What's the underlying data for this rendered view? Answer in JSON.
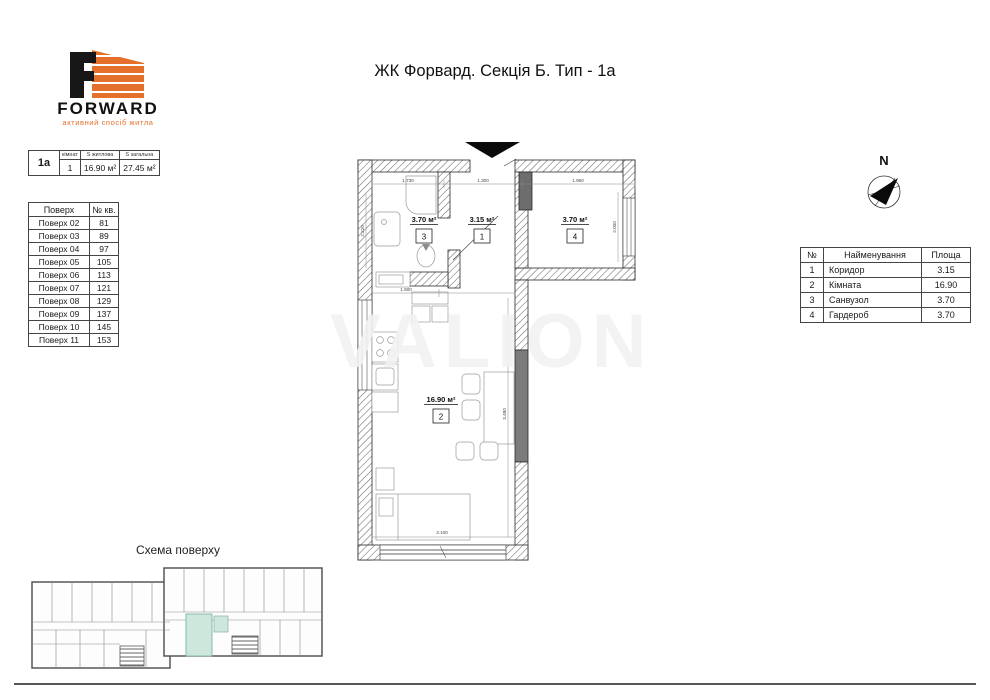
{
  "title": "ЖК Форвард. Секція Б. Тип - 1а",
  "watermark": "VALION",
  "logo": {
    "brand": "FORWARD",
    "tagline": "активний спосіб житла",
    "accent_color": "#e5702b"
  },
  "info_table": {
    "type_label": "1а",
    "col_rooms": "кімнат",
    "col_living": "S житлова",
    "col_total": "S загальна",
    "rooms_count": "1",
    "living_area": "16.90 м²",
    "total_area": "27.45 м²"
  },
  "floors_table": {
    "col_floor": "Поверх",
    "col_apt": "№ кв.",
    "rows": [
      {
        "floor": "Поверх 02",
        "apt": "81"
      },
      {
        "floor": "Поверх 03",
        "apt": "89"
      },
      {
        "floor": "Поверх 04",
        "apt": "97"
      },
      {
        "floor": "Поверх 05",
        "apt": "105"
      },
      {
        "floor": "Поверх 06",
        "apt": "113"
      },
      {
        "floor": "Поверх 07",
        "apt": "121"
      },
      {
        "floor": "Поверх 08",
        "apt": "129"
      },
      {
        "floor": "Поверх 09",
        "apt": "137"
      },
      {
        "floor": "Поверх 10",
        "apt": "145"
      },
      {
        "floor": "Поверх 11",
        "apt": "153"
      }
    ]
  },
  "rooms_table": {
    "col_num": "№",
    "col_name": "Найменування",
    "col_area": "Площа",
    "rows": [
      {
        "num": "1",
        "name": "Коридор",
        "area": "3.15"
      },
      {
        "num": "2",
        "name": "Кімната",
        "area": "16.90"
      },
      {
        "num": "3",
        "name": "Санвузол",
        "area": "3.70"
      },
      {
        "num": "4",
        "name": "Гардероб",
        "area": "3.70"
      }
    ]
  },
  "compass": {
    "label": "N"
  },
  "plan": {
    "rooms": [
      {
        "num": "1",
        "area_label": "3.15 м²"
      },
      {
        "num": "2",
        "area_label": "16.90 м²"
      },
      {
        "num": "3",
        "area_label": "3.70 м²"
      },
      {
        "num": "4",
        "area_label": "3.70 м²"
      }
    ],
    "dimensions": {
      "top_left": "1.730",
      "top_mid": "1.300",
      "top_right": "1.960",
      "room3_depth": "2.220",
      "room4_depth": "2.000",
      "kitchen": "1.600",
      "room2_depth": "3.480",
      "window": "3.100"
    }
  },
  "scheme": {
    "title": "Схема поверху",
    "highlight_color": "#cde7dd"
  }
}
